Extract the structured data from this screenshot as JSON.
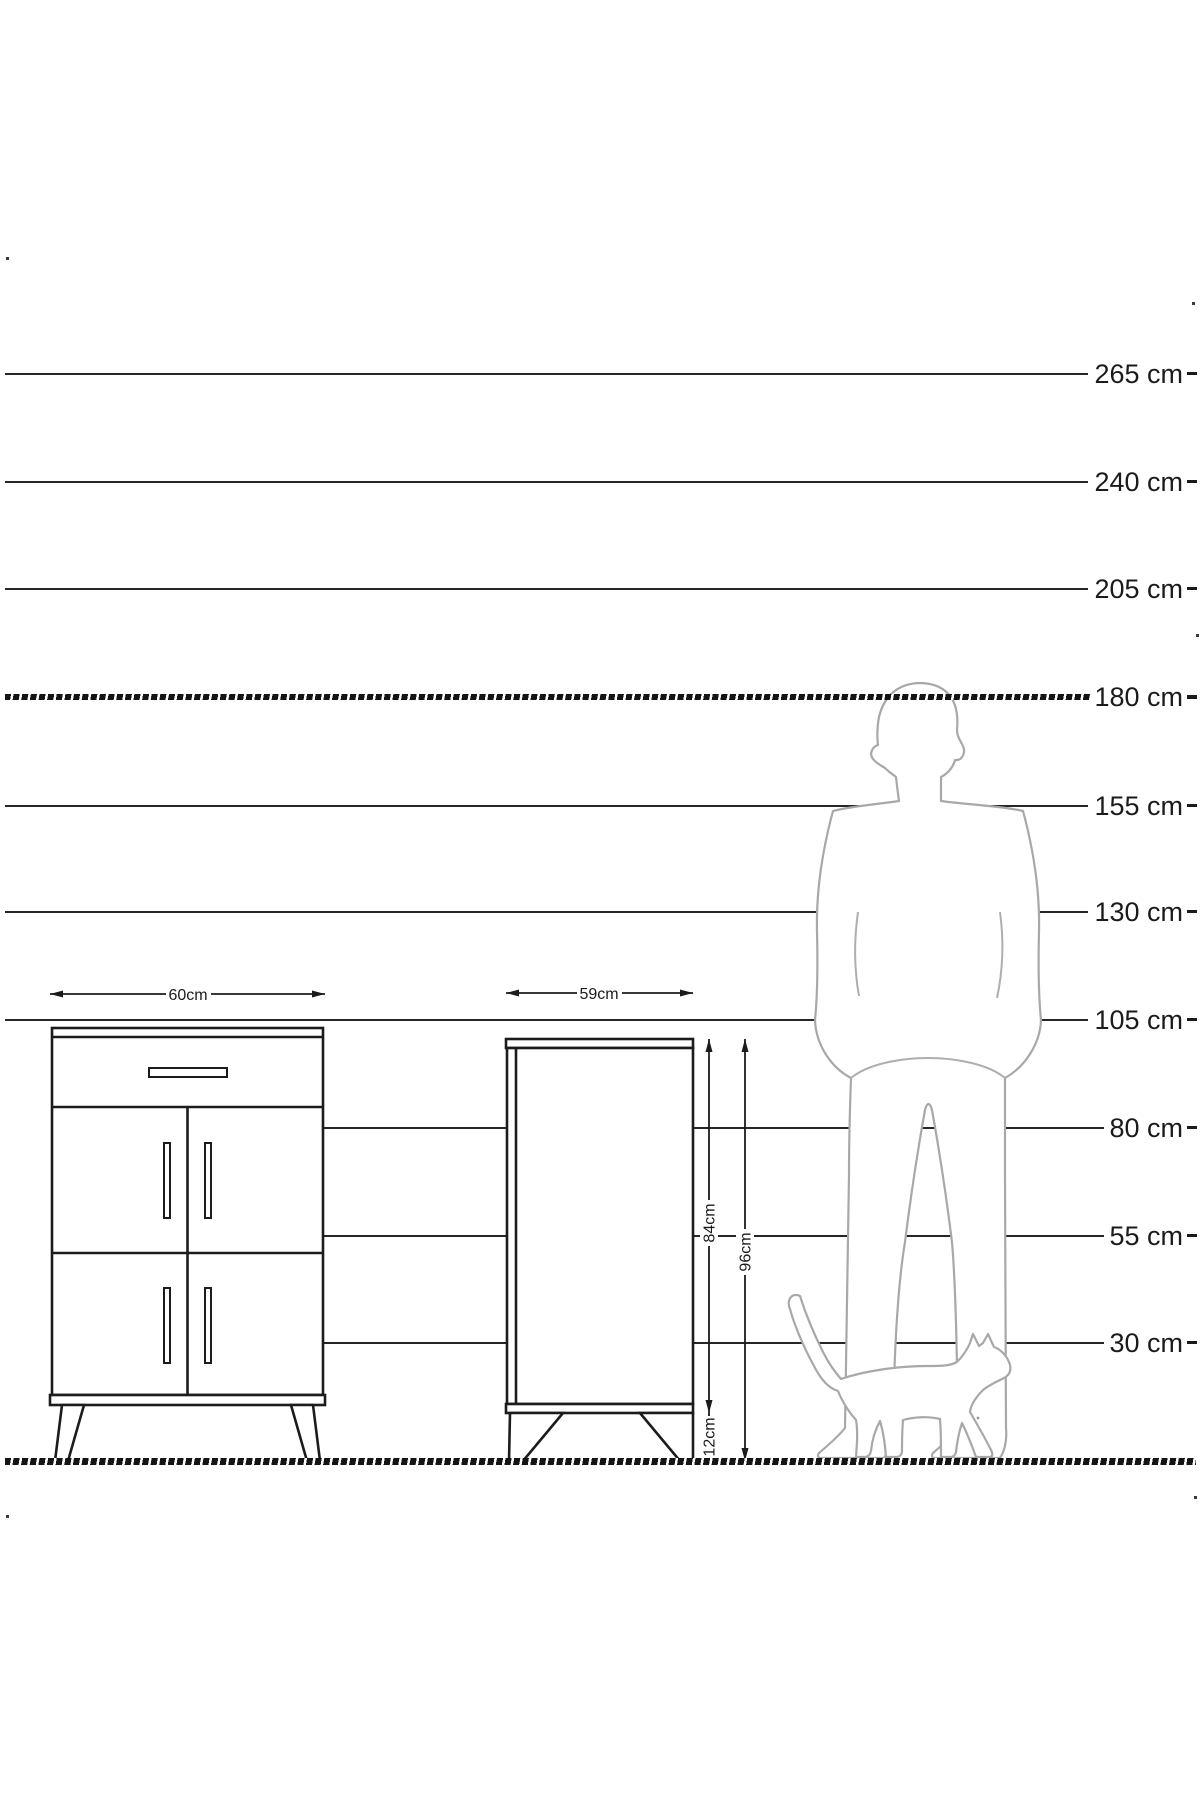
{
  "diagram": {
    "unit": "cm",
    "ruler": {
      "lines": [
        {
          "label": "265 cm",
          "value": 265
        },
        {
          "label": "240 cm",
          "value": 240
        },
        {
          "label": "205 cm",
          "value": 205
        },
        {
          "label": "180 cm",
          "value": 180,
          "style": "hatched"
        },
        {
          "label": "155 cm",
          "value": 155
        },
        {
          "label": "130 cm",
          "value": 130
        },
        {
          "label": "105 cm",
          "value": 105
        },
        {
          "label": "80 cm",
          "value": 80
        },
        {
          "label": "55 cm",
          "value": 55
        },
        {
          "label": "30 cm",
          "value": 30
        }
      ]
    },
    "front_view_cabinet": {
      "width_label": "60cm",
      "width_value": 60
    },
    "side_view_cabinet": {
      "width_label": "59cm",
      "width_value": 59,
      "body_height_label": "84cm",
      "body_height_value": 84,
      "total_height_label": "96cm",
      "total_height_value": 96,
      "leg_height_label": "12cm",
      "leg_height_value": 12
    },
    "figures": {
      "man": "man-silhouette",
      "cat": "cat-silhouette"
    },
    "colors": {
      "line": "#262626",
      "cabinet_stroke": "#1c1c1c",
      "silhouette": "#a8a8a8",
      "background": "#ffffff"
    }
  }
}
